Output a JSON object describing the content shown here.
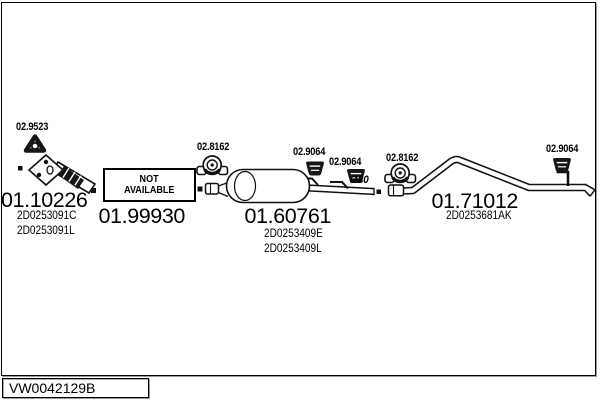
{
  "diagram": {
    "catalog_code": "VW0042129B",
    "sections": [
      {
        "part_number": "01.10226",
        "oem_codes": [
          "2D0253091C",
          "2D0253091L"
        ]
      },
      {
        "part_number": "01.99930",
        "status_line1": "NOT",
        "status_line2": "AVAILABLE"
      },
      {
        "part_number": "01.60761",
        "oem_codes": [
          "2D0253409E",
          "2D0253409L"
        ]
      },
      {
        "part_number": "01.71012",
        "oem_codes": [
          "2D0253681AK"
        ]
      }
    ],
    "fittings": {
      "gasket": "02.9523",
      "clamps": [
        "02.8162",
        "02.8162"
      ],
      "mounts": [
        "02.9064",
        "02.9064",
        "02.9064"
      ],
      "pipe_diameter": "Ø80"
    }
  }
}
